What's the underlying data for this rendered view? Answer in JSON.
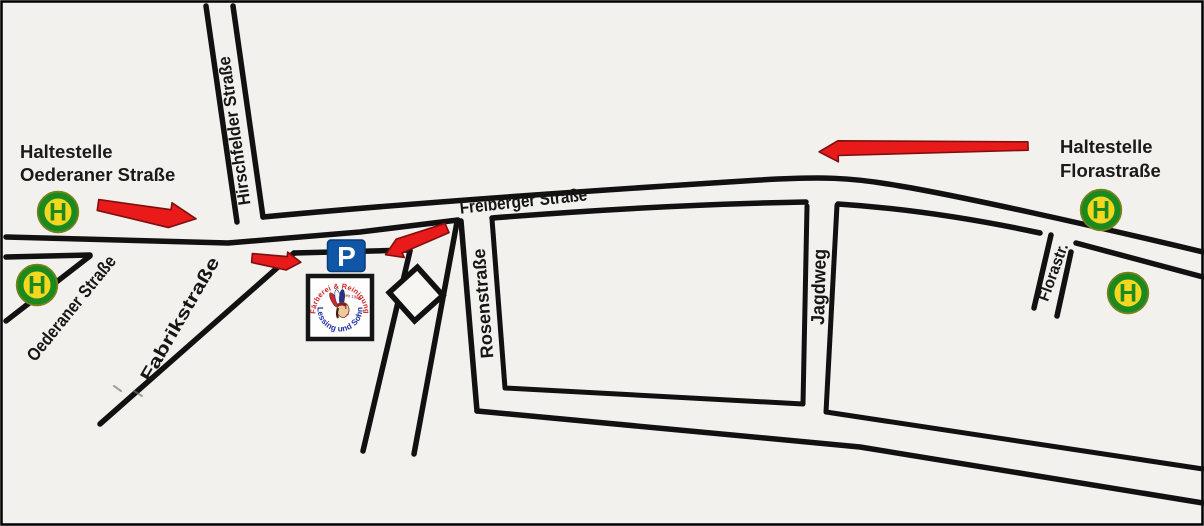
{
  "map": {
    "stops": {
      "left": {
        "line1": "Haltestelle",
        "line2": "Oederaner Straße"
      },
      "right": {
        "line1": "Haltestelle",
        "line2": "Florastraße"
      }
    },
    "bus_stop_sign_letter": "H",
    "parking_sign_letter": "P",
    "streets": {
      "freiberger": "Freiberger Straße",
      "hirschfelder": "Hirschfelder Straße",
      "oederaner": "Oederaner Straße",
      "fabrik": "Fabrikstraße",
      "rosen": "Rosenstraße",
      "jagdweg": "Jagdweg",
      "flora": "Florastr."
    },
    "logo": {
      "arc_top": "Färberei & Reinigung",
      "arc_bottom": "Lessing und Sohn",
      "since": "seit 1884"
    },
    "colors": {
      "background": "#f2f1ee",
      "road": "#111111",
      "arrow_fill": "#e81a1a",
      "arrow_outline": "#7e0f0f",
      "bus_green": "#1b8a1e",
      "bus_yellow": "#f6d71f",
      "bus_edge": "#77801a",
      "parking_blue": "#1056a6",
      "parking_edge": "#0a3c78",
      "logo_red": "#cf2222",
      "logo_blue": "#2431a5",
      "label_text": "#161616"
    }
  }
}
